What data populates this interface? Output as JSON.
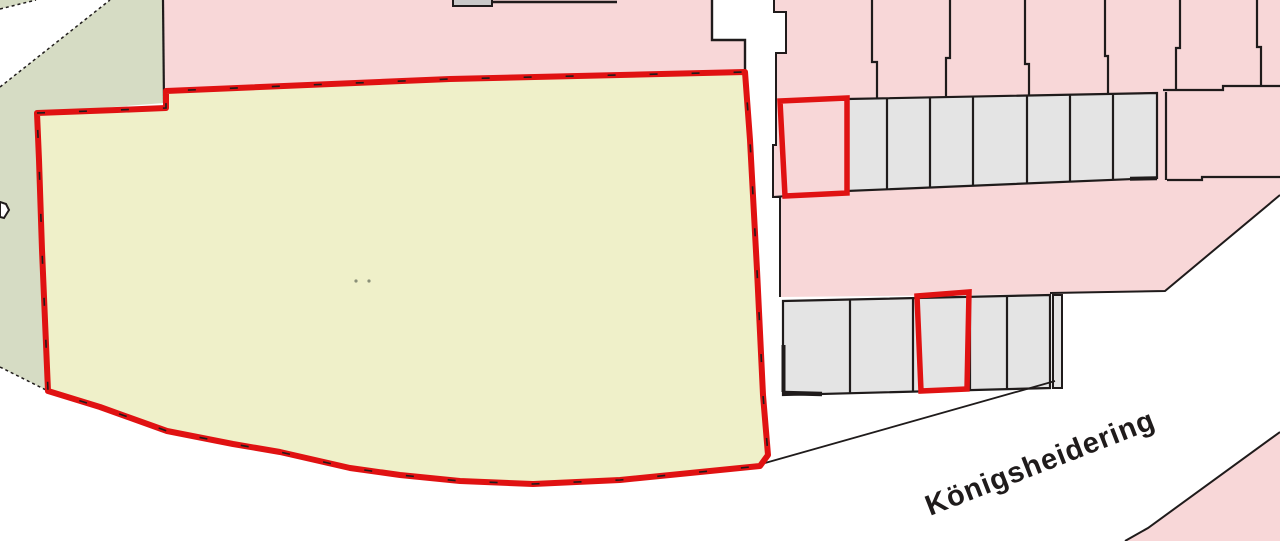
{
  "map": {
    "street_label": "Königsheidering",
    "colors": {
      "background": "#ffffff",
      "residential": "#f8d7d8",
      "parcel-yellow": "#eff0c9",
      "green-space": "#d6dcc4",
      "garage": "#e4e4e4",
      "building": "#c9c9c9",
      "highlight": "#e01212",
      "boundary": "#1f1b1b",
      "road": "#ffffff",
      "dot": "#8a8f78"
    }
  }
}
